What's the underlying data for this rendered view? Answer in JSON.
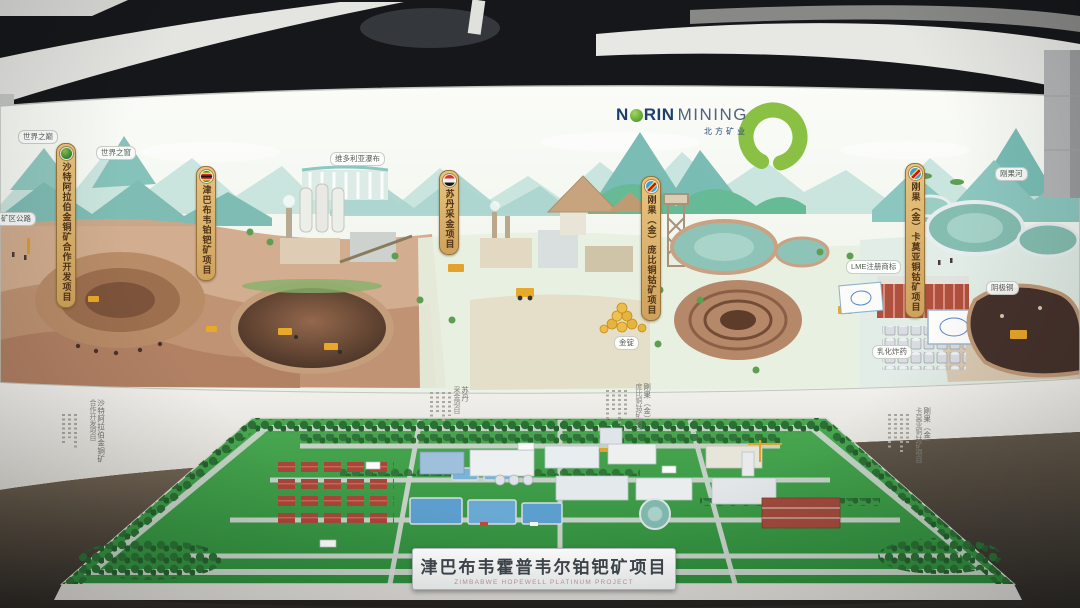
{
  "exhibit": {
    "brand": {
      "n": "N",
      "rin": "RIN",
      "mining": "MINING",
      "cn": "北方矿业"
    },
    "banners": [
      {
        "flag": "norin",
        "label": "沙特阿拉伯金铜矿合作开发项目"
      },
      {
        "flag": "zimbabwe",
        "label": "津巴布韦铂钯矿项目"
      },
      {
        "flag": "sudan",
        "label": "苏丹采金项目"
      },
      {
        "flag": "drc",
        "label": "刚果（金）庞比铜钴矿项目"
      },
      {
        "flag": "drc",
        "label": "刚果（金）卡莫亚铜钴矿项目"
      }
    ],
    "map_labels": [
      {
        "text": "矿区公路"
      },
      {
        "text": "世界之巅"
      },
      {
        "text": "世界之窗"
      },
      {
        "text": "维多利亚瀑布"
      },
      {
        "text": "金锭"
      },
      {
        "text": "LME注册商标"
      },
      {
        "text": "阴极铜"
      },
      {
        "text": "乳化炸药"
      },
      {
        "text": "刚果河"
      }
    ],
    "wall_texts": [
      {
        "line1": "沙特阿拉伯金铜矿",
        "line2": "合作开发项目"
      },
      {
        "line1": "苏丹",
        "line2": "采金项目"
      },
      {
        "line1": "刚果（金）",
        "line2": "庞比铜钴矿项目"
      },
      {
        "line1": "刚果（金）",
        "line2": "卡莫亚铜钴矿项目"
      }
    ],
    "model_plaque": {
      "cn": "津巴布韦霍普韦尔铂钯矿项目",
      "en": "ZIMBABWE HOPEWELL PLATINUM PROJECT"
    },
    "colors": {
      "screen_teal": "#7fbcb4",
      "banner_wood": "#d9b36a",
      "brand_navy": "#1e3f6e",
      "brand_green": "#8ac043",
      "model_green": "#3f9e4a",
      "desert_tan": "#c89f7e"
    }
  }
}
